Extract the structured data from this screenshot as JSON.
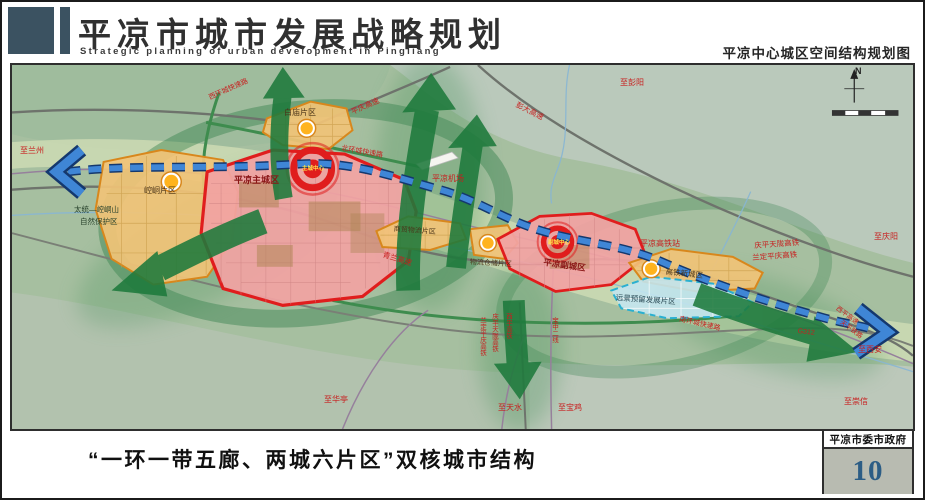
{
  "header": {
    "title": "平凉市城市发展战略规划",
    "subtitle_en": "Strategic planning of urban development in Pingliang",
    "map_title": "平凉中心城区空间结构规划图"
  },
  "footer": {
    "caption": "“一环一带五廊、两城六片区”双核城市结构",
    "org": "平凉市委市政府",
    "page_number": "10"
  },
  "colors": {
    "header_accent": "#3b5261",
    "city_zone_red": "#e01d1d",
    "district_orange": "#d8871c",
    "reserved_blue": "#2ab0d0",
    "belt_blue": "#3f86d6",
    "corridor_green": "#1e7a3c",
    "label_red": "#c81e1e",
    "page_number_blue": "#2c5d85"
  },
  "map": {
    "labels": [
      {
        "name": "label-to-lanzhou",
        "text": "至兰州",
        "x": 8,
        "y": 82,
        "color": "#c81e1e",
        "size": 8
      },
      {
        "name": "label-west-ring-road",
        "text": "西环城快速路",
        "x": 196,
        "y": 30,
        "rot": -24,
        "color": "#c81e1e",
        "size": 7
      },
      {
        "name": "label-pingqing-expressway",
        "text": "平庆高速",
        "x": 338,
        "y": 44,
        "rot": -24,
        "color": "#c81e1e",
        "size": 7.5
      },
      {
        "name": "label-to-pengyang",
        "text": "至彭阳",
        "x": 608,
        "y": 14,
        "color": "#c81e1e",
        "size": 8
      },
      {
        "name": "label-pengda-expressway",
        "text": "彭大高速",
        "x": 506,
        "y": 36,
        "rot": 27,
        "color": "#c81e1e",
        "size": 7.5
      },
      {
        "name": "label-to-qingyang",
        "text": "至庆阳",
        "x": 862,
        "y": 168,
        "color": "#c81e1e",
        "size": 8
      },
      {
        "name": "label-baimiao-district",
        "text": "白庙片区",
        "x": 272,
        "y": 44,
        "color": "#4a3418",
        "size": 8
      },
      {
        "name": "label-north-ring-road",
        "text": "北环城快速路",
        "x": 330,
        "y": 80,
        "rot": 10,
        "color": "#c81e1e",
        "size": 7
      },
      {
        "name": "label-airport",
        "text": "平凉机场",
        "x": 420,
        "y": 110,
        "color": "#c81e1e",
        "size": 8
      },
      {
        "name": "label-main-city",
        "text": "平凉主城区",
        "x": 222,
        "y": 111,
        "color": "#8a1616",
        "size": 9,
        "bold": true
      },
      {
        "name": "label-main-core",
        "text": "主城中心",
        "x": 290,
        "y": 102,
        "color": "#ffe24a",
        "size": 5.5,
        "bold": true
      },
      {
        "name": "label-kongtong-district",
        "text": "崆峒片区",
        "x": 132,
        "y": 122,
        "color": "#4a3418",
        "size": 8
      },
      {
        "name": "label-nature-reserve-line1",
        "text": "太统—崆峒山",
        "x": 62,
        "y": 141,
        "color": "#26402a",
        "size": 7.5
      },
      {
        "name": "label-nature-reserve-line2",
        "text": "自然保护区",
        "x": 68,
        "y": 153,
        "color": "#26402a",
        "size": 7.5
      },
      {
        "name": "label-qinglan-expressway",
        "text": "青兰高速",
        "x": 372,
        "y": 186,
        "rot": 17,
        "color": "#c81e1e",
        "size": 7.5
      },
      {
        "name": "label-trade-logistics-district",
        "text": "商贸物流片区",
        "x": 382,
        "y": 161,
        "rot": 4,
        "color": "#4a3418",
        "size": 7
      },
      {
        "name": "label-warehouse-district",
        "text": "物流仓储片区",
        "x": 458,
        "y": 194,
        "rot": 3,
        "color": "#4a3418",
        "size": 7
      },
      {
        "name": "label-sub-core",
        "text": "副城中心",
        "x": 536,
        "y": 176,
        "color": "#ffe24a",
        "size": 5.5,
        "bold": true
      },
      {
        "name": "label-sub-city",
        "text": "平凉副城区",
        "x": 532,
        "y": 193,
        "rot": 8,
        "color": "#8a1616",
        "size": 8.5,
        "bold": true
      },
      {
        "name": "label-hsr-station",
        "text": "平凉高铁站",
        "x": 628,
        "y": 175,
        "color": "#c81e1e",
        "size": 8
      },
      {
        "name": "label-hsr-line-1",
        "text": "庆平天陇高铁",
        "x": 742,
        "y": 177,
        "rot": -4,
        "color": "#c81e1e",
        "size": 7.5
      },
      {
        "name": "label-hsr-line-2",
        "text": "兰定平庆高铁",
        "x": 740,
        "y": 189,
        "rot": -4,
        "color": "#c81e1e",
        "size": 7.5
      },
      {
        "name": "label-hsr-newtown",
        "text": "高铁新城区",
        "x": 654,
        "y": 203,
        "rot": 6,
        "color": "#4a3418",
        "size": 7.5
      },
      {
        "name": "label-reserved-district",
        "text": "远景预留发展片区",
        "x": 604,
        "y": 229,
        "rot": 4,
        "color": "#2a4a55",
        "size": 7.5
      },
      {
        "name": "label-south-ring-road",
        "text": "南环城快速路",
        "x": 668,
        "y": 251,
        "rot": 13,
        "color": "#c81e1e",
        "size": 7
      },
      {
        "name": "label-g312",
        "text": "G312",
        "x": 786,
        "y": 263,
        "rot": 6,
        "color": "#c81e1e",
        "size": 7
      },
      {
        "name": "label-xiping-expressway",
        "text": "西平高速",
        "x": 826,
        "y": 241,
        "rot": 36,
        "color": "#c81e1e",
        "size": 6.5
      },
      {
        "name": "label-tianping-railway",
        "text": "天平铁路",
        "x": 830,
        "y": 255,
        "rot": 36,
        "color": "#c81e1e",
        "size": 6.5
      },
      {
        "name": "label-to-xian",
        "text": "至西安",
        "x": 846,
        "y": 281,
        "color": "#c81e1e",
        "size": 8
      },
      {
        "name": "label-to-chongxin",
        "text": "至崇信",
        "x": 832,
        "y": 333,
        "color": "#c81e1e",
        "size": 8
      },
      {
        "name": "label-rail-vertical-1",
        "text": "兰定平庆高铁",
        "x": 466,
        "y": 252,
        "vertical": true,
        "color": "#c81e1e",
        "size": 6.5
      },
      {
        "name": "label-rail-vertical-2",
        "text": "庆平天陇高铁",
        "x": 478,
        "y": 248,
        "vertical": true,
        "color": "#c81e1e",
        "size": 6.5
      },
      {
        "name": "label-rail-vertical-3",
        "text": "西平高铁",
        "x": 492,
        "y": 248,
        "vertical": true,
        "color": "#c81e1e",
        "size": 6.5
      },
      {
        "name": "label-baozhong-railway",
        "text": "宝中二线",
        "x": 538,
        "y": 252,
        "vertical": true,
        "color": "#c81e1e",
        "size": 6.5
      },
      {
        "name": "label-to-huating",
        "text": "至华亭",
        "x": 312,
        "y": 331,
        "color": "#c81e1e",
        "size": 8
      },
      {
        "name": "label-to-tianshui",
        "text": "至天水",
        "x": 486,
        "y": 339,
        "color": "#c81e1e",
        "size": 8
      },
      {
        "name": "label-to-baoji",
        "text": "至宝鸡",
        "x": 546,
        "y": 339,
        "color": "#c81e1e",
        "size": 8
      },
      {
        "name": "compass-n-label",
        "text": "N",
        "x": 843,
        "y": 2,
        "color": "#222222",
        "size": 9,
        "bold": true
      }
    ]
  }
}
